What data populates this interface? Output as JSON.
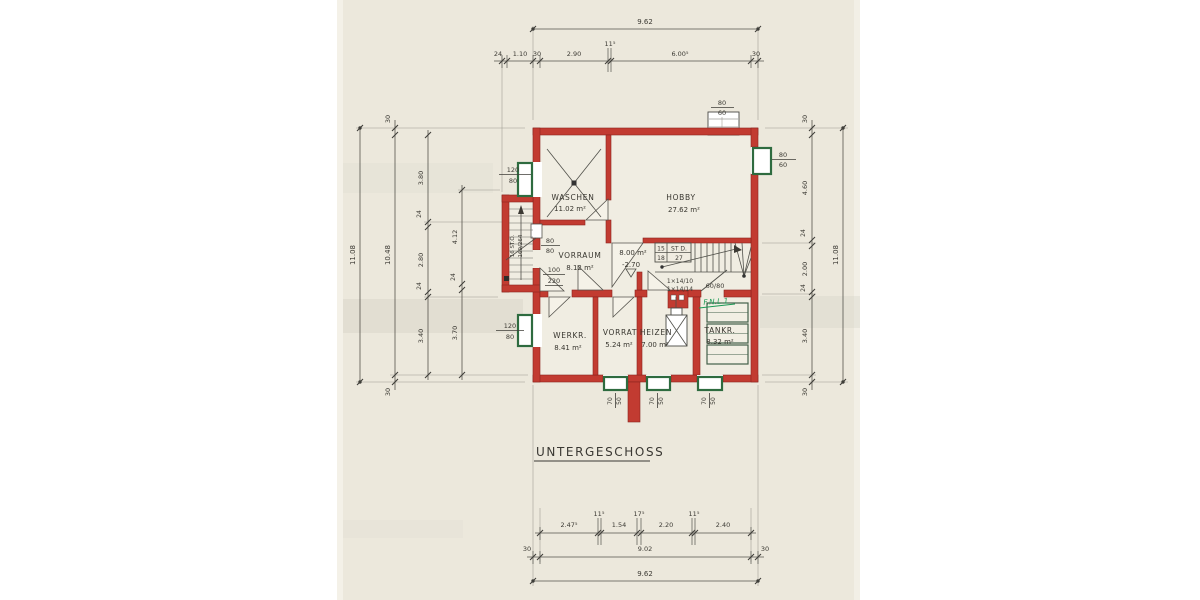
{
  "title": "UNTERGESCHOSS",
  "colors": {
    "wall_red": "#c23b31",
    "window_green": "#2e6b3f",
    "paper": "#ece8dc",
    "note_green": "#1b9a55"
  },
  "rooms": {
    "waschen": {
      "name": "WASCHEN",
      "area": "11.02 m²"
    },
    "hobby": {
      "name": "HOBBY",
      "area": "27.62 m²"
    },
    "vorraum": {
      "name": "VORRAUM",
      "area": "8.12 m²"
    },
    "flur": {
      "area": "8.00 m²",
      "level": "-2.70"
    },
    "werkraum": {
      "name": "WERKR.",
      "area": "8.41 m²"
    },
    "vorrat": {
      "name": "VORRAT",
      "area": "5.24 m²"
    },
    "heizen": {
      "name": "HEIZEN",
      "area": "7.00 m²"
    },
    "tankraum": {
      "name": "TANKR.",
      "area": "8.32 m²"
    }
  },
  "stairs": {
    "main": {
      "c11": "15",
      "c12": "ST D.",
      "c21": "18",
      "c22": "27"
    },
    "exterior": {
      "line1": "16 ST.Ö.",
      "line2": "169/264"
    },
    "steps_note1": "1×14/10",
    "steps_note2": "1×14/14"
  },
  "openings": {
    "window_waschen": {
      "num": "120",
      "den": "80"
    },
    "window_kleinfenster": {
      "num": "80",
      "den": "80"
    },
    "door_entrance": {
      "num": "100",
      "den": "220"
    },
    "window_werkraum": {
      "num": "120",
      "den": "80"
    },
    "window_hobby": {
      "num": "80",
      "den": "60"
    },
    "chimney": {
      "num": "80",
      "den": "60"
    },
    "door_tank": "60/80",
    "window_bottom": {
      "num": "70",
      "den": "50"
    }
  },
  "note_green": "F.N.L.1",
  "dims": {
    "top": {
      "overall": "9.62",
      "labels": [
        "24",
        "1.10",
        "30",
        "2.90",
        "11⁵",
        "6.00⁵",
        "30"
      ]
    },
    "bottom": {
      "detail": [
        "2.47⁵",
        "11⁵",
        "1.54",
        "17⁵",
        "2.20",
        "11⁵",
        "2.40"
      ],
      "mid": [
        "30",
        "9.02",
        "30"
      ],
      "overall": "9.62"
    },
    "left": {
      "overall": "11.08",
      "outer": [
        "30",
        "10.48",
        "30"
      ],
      "rooms": [
        "3.80",
        "24",
        "2.80",
        "24",
        "3.40"
      ],
      "inner": [
        "4.12",
        "24",
        "3.70"
      ]
    },
    "right": {
      "chain": [
        "30",
        "4.60",
        "24",
        "2.00",
        "24",
        "3.40",
        "30"
      ],
      "overall": "11.08"
    }
  }
}
